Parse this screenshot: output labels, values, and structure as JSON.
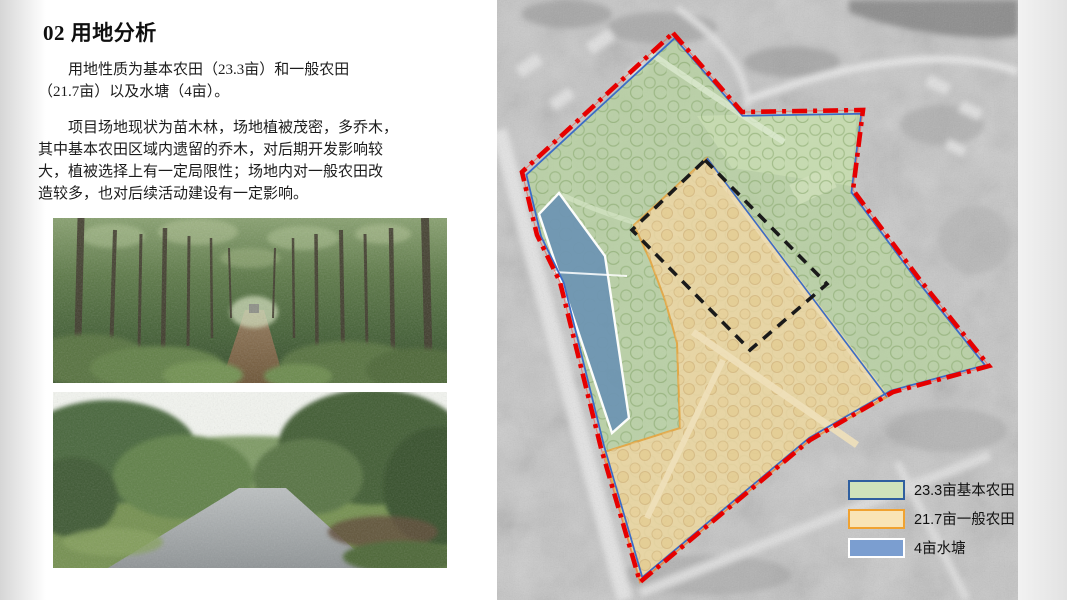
{
  "slide": {
    "title": "02 用地分析",
    "body": {
      "paragraph1": "　　用地性质为基本农田（23.3亩）和一般农田\n（21.7亩）以及水塘（4亩）。",
      "paragraph2": "　　项目场地现状为苗木林，场地植被茂密，多乔木，\n其中基本农田区域内遗留的乔木，对后期开发影响较\n大，植被选择上有一定局限性；场地内对一般农田改\n造较多，也对后续活动建设有一定影响。"
    }
  },
  "map": {
    "legend": [
      {
        "label": "23.3亩基本农田",
        "fill": "#cfe3bb",
        "border": "#2f5f9f"
      },
      {
        "label": "21.7亩一般农田",
        "fill": "#f9e4b6",
        "border": "#f0a231"
      },
      {
        "label": "4亩水塘",
        "fill": "#7b9ed0",
        "border": "#ffffff"
      }
    ],
    "colors": {
      "basic_farmland_fill": "#b7d2a0",
      "general_farmland_fill": "#ecd5a4",
      "general_farmland_stroke": "#e8a33c",
      "pond_fill": "#6e95b2",
      "pond_stroke": "#ffffff",
      "site_boundary": "#e60000",
      "farmland_outline_blue": "#3b6cc7",
      "development_boundary": "#1a1a1a"
    }
  }
}
